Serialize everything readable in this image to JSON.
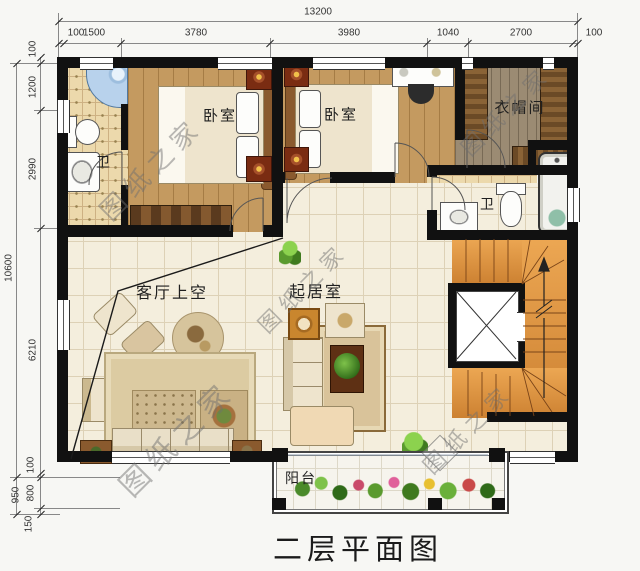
{
  "title": "二层平面图",
  "watermark": {
    "text": "图纸之家"
  },
  "dimensions": {
    "top": {
      "overall": "13200",
      "segments": [
        "100",
        "1500",
        "3780",
        "3980",
        "1040",
        "2700",
        "100"
      ]
    },
    "left": {
      "overall": "10600",
      "lower": "950",
      "segments": [
        "100",
        "1200",
        "2990",
        "6210",
        "100",
        "800",
        "150"
      ]
    }
  },
  "rooms": {
    "bathroom_left": "卫",
    "bedroom_left": "卧室",
    "bedroom_right": "卧室",
    "cloakroom": "衣帽间",
    "bathroom_right": "卫",
    "living_void": "客厅上空",
    "sitting_room": "起居室",
    "balcony": "阳台"
  },
  "colors": {
    "wall": "#111111",
    "wood_floor": "#c49a60",
    "tile_floor": "#ecd9ac",
    "cream_floor": "#f4eedd",
    "stair_wood": "#e2953f",
    "shower_blue": "#b8d2ec"
  }
}
